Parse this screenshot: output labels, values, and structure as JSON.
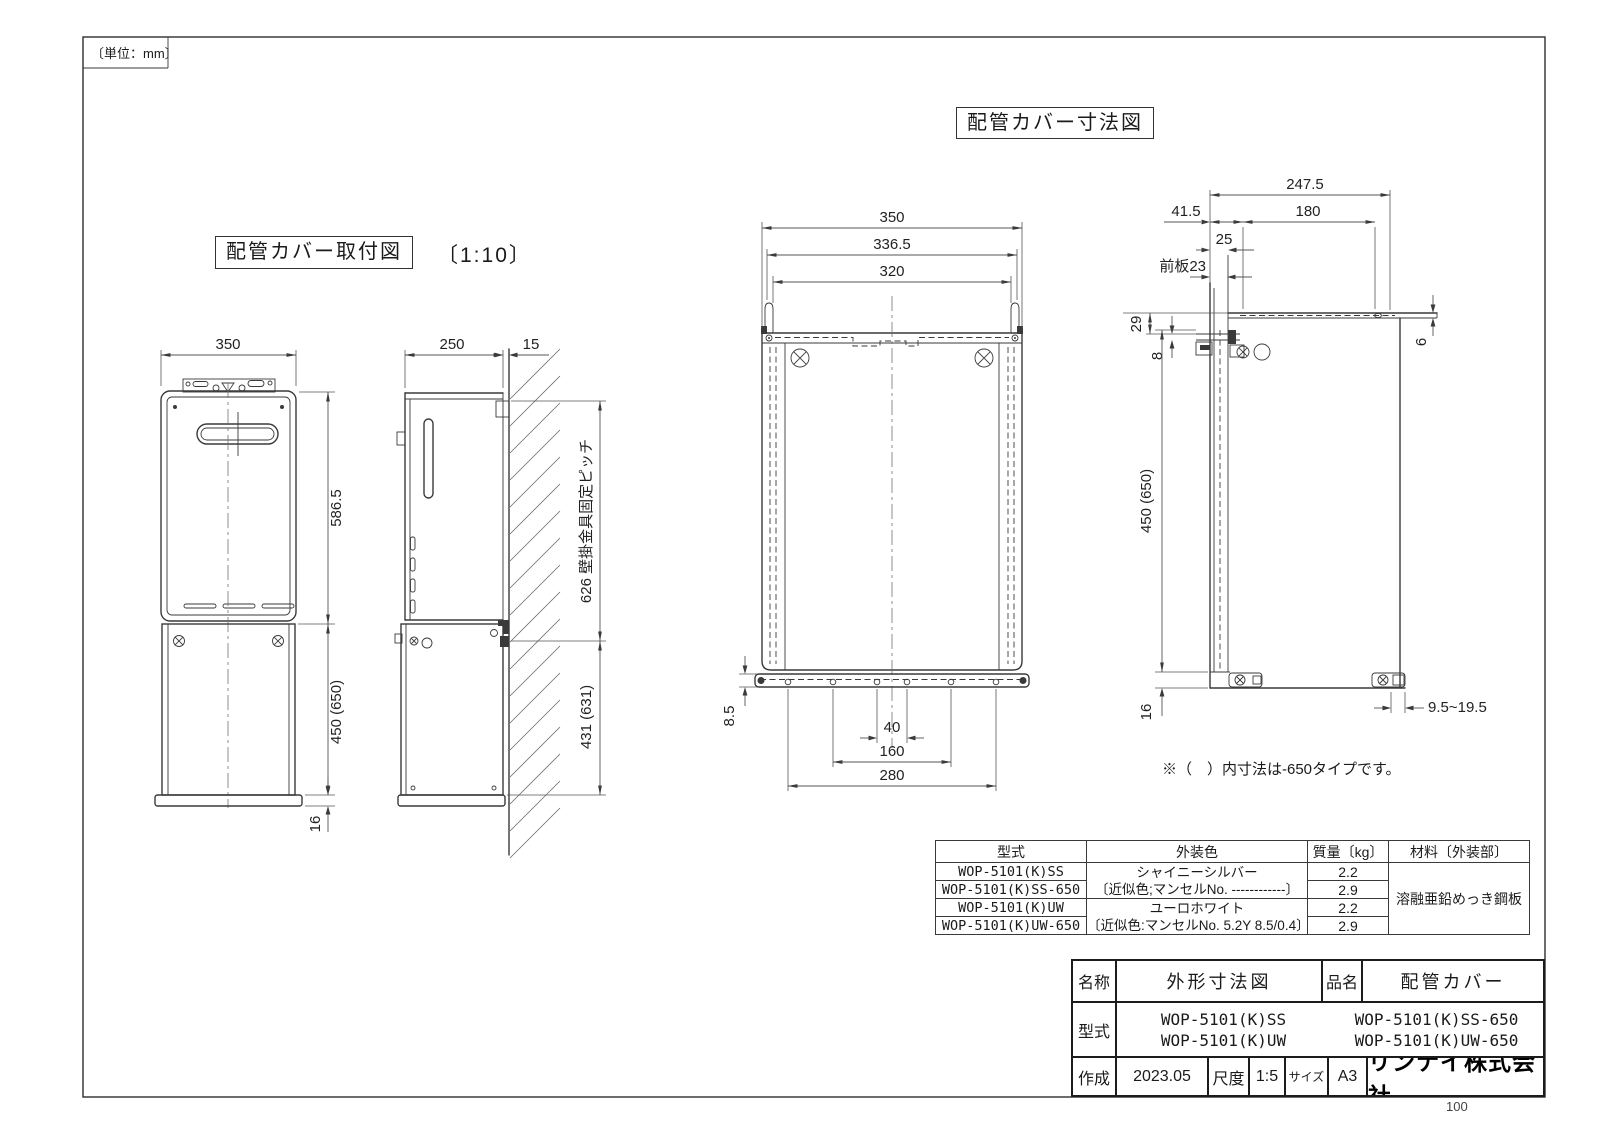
{
  "page": {
    "unit_note": "〔単位：mm〕",
    "page_number": "100"
  },
  "titles": {
    "install": "配管カバー取付図",
    "install_scale": "〔1:10〕",
    "dims": "配管カバー寸法図"
  },
  "note": "※（　）内寸法は-650タイプです。",
  "install_view": {
    "front_width": "350",
    "front_height": "586.5",
    "cover_height": "450 (650)",
    "cover_bottom": "16",
    "side_depth": "250",
    "wall_gap": "15",
    "mount_pitch": "626 壁掛金具固定ピッチ",
    "side_cover_height": "431 (631)"
  },
  "dim_view": {
    "front": {
      "width": "350",
      "width_outer": "336.5",
      "width_inner": "320",
      "flange": "8.5",
      "pitch_a": "40",
      "pitch_b": "160",
      "pitch_c": "280"
    },
    "side": {
      "total": "247.5",
      "offset": "41.5",
      "arm": "180",
      "front_gap": "25",
      "front_plate": "前板23",
      "hook_top": "29",
      "hook": "8",
      "arm_thick": "6",
      "height": "450 (650)",
      "bottom": "16",
      "wall_range": "9.5~19.5"
    }
  },
  "spec_table": {
    "headers": {
      "model": "型式",
      "color": "外装色",
      "mass": "質量〔kg〕",
      "material": "材料〔外装部〕"
    },
    "rows": [
      {
        "model": "WOP-5101(K)SS",
        "mass": "2.2"
      },
      {
        "model": "WOP-5101(K)SS-650",
        "mass": "2.9"
      },
      {
        "model": "WOP-5101(K)UW",
        "mass": "2.2"
      },
      {
        "model": "WOP-5101(K)UW-650",
        "mass": "2.9"
      }
    ],
    "color_groups": [
      {
        "name": "シャイニーシルバー",
        "munsell": "〔近似色;マンセルNo. ------------〕"
      },
      {
        "name": "ユーロホワイト",
        "munsell": "〔近似色:マンセルNo. 5.2Y 8.5/0.4〕"
      }
    ],
    "material": "溶融亜鉛めっき鋼板"
  },
  "title_block": {
    "name_label": "名称",
    "name_value": "外形寸法図",
    "item_label": "品名",
    "item_value": "配管カバー",
    "model_label": "型式",
    "models": [
      "WOP-5101(K)SS",
      "WOP-5101(K)SS-650",
      "WOP-5101(K)UW",
      "WOP-5101(K)UW-650"
    ],
    "date_label": "作成",
    "date_value": "2023.05",
    "scale_label": "尺度",
    "scale_value": "1:5",
    "size_label": "サイズ",
    "size_value": "A3",
    "company": "リンナイ株式会社"
  }
}
